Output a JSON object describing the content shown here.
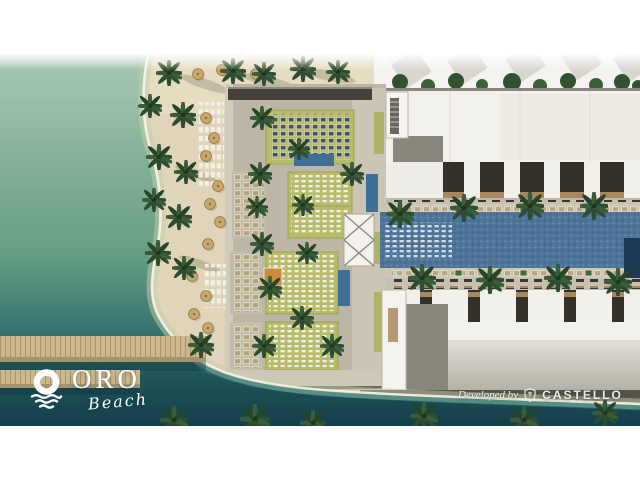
{
  "branding": {
    "logo_name": "ORO",
    "logo_sub": "Beach",
    "logo_icon": "sunset-over-waves-icon",
    "logo_color": "#ffffff"
  },
  "developer": {
    "prefix": "Developed by",
    "name": "CASTELLO",
    "icon": "castello-crest-icon",
    "text_color": "#ecebe7"
  },
  "palette": {
    "page_background": "#ffffff",
    "water_shallow": "#a9c7b4",
    "water_mid": "#639c82",
    "water_deep": "#143f4a",
    "foam": "#f6f4ea",
    "sand": "#e0d5ba",
    "deck_paving": "#bdb6a7",
    "lawn_green": "#b6bc6a",
    "pool_blue": "#4e749a",
    "building_white": "#f3f1ec",
    "roof_grey": "#8b867c",
    "window_bay_dark": "#34302a",
    "wood_tan": "#a8875c",
    "pier_wood": "#ccb88e",
    "palm_green": "#2e4d30",
    "umbrella_straw": "#c9a86b"
  }
}
